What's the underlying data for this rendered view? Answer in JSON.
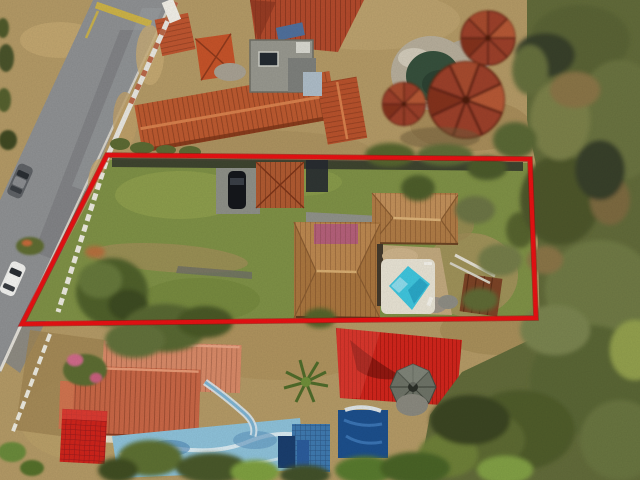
{
  "image": {
    "type": "aerial-drone-photograph",
    "description": "Aerial drone photo of a residential lot outlined with a red property boundary. Inside the boundary: green lawn, white balustrade fence along the road, carport with a dark car, main house with tan terracotta hip roofs and a pink roof patch, white pool deck with turquoise swimming pool, wooden rear deck and shrubs. Around it: a gray road with yellow speed bump and two parked cars (white and gray), neighboring terracotta-roofed buildings, a round stone-rimmed pond with three conical red-tile palapa roofs, a southern neighbor with salmon and bright-red roofs, blue painted pool deck, navy pool, red metal carport roof and a gazebo, all bordered by dense olive-green forest on the right."
  },
  "overlay": {
    "name": "red-property-boundary",
    "color": "#e81113",
    "points": "107,155 530,159 536,318 22,324",
    "stroke_px": 4
  },
  "palette": {
    "boundary_red": "#e81113",
    "road_asphalt": "#8f9193",
    "dry_grass": "#b49a66",
    "lawn_green": "#7f9146",
    "forest_olive": "#626b3a",
    "terracotta_roof": "#bd5a30",
    "house_tan_roof": "#b07c46",
    "pink_roof_patch": "#b5607a",
    "salmon_roof": "#d98a68",
    "bright_red_roof": "#cf241b",
    "pool_turquoise": "#3fc6de",
    "pool_deck_white": "#e8e3d4",
    "pond_water": "#36503c",
    "blue_pool_deck": "#8ec2da",
    "navy_pool": "#1c4f8c",
    "fence_white": "#eceadf",
    "speed_bump_yellow": "#d8b93c"
  },
  "objects": [
    {
      "name": "red-property-boundary",
      "label": "Red outlined lot"
    },
    {
      "name": "road",
      "label": "Asphalt road with speed bump"
    },
    {
      "name": "white-car",
      "label": "White parked car"
    },
    {
      "name": "gray-car",
      "label": "Gray parked car"
    },
    {
      "name": "white-fence",
      "label": "White wall and balustrade fence"
    },
    {
      "name": "north-neighbor-buildings",
      "label": "Terracotta roofed buildings"
    },
    {
      "name": "round-pond",
      "label": "Stone-rimmed round pond"
    },
    {
      "name": "palapa-roofs",
      "label": "Three conical tiled palapa roofs"
    },
    {
      "name": "carport",
      "label": "Carport with dark car"
    },
    {
      "name": "main-house",
      "label": "Main house tan hip roofs"
    },
    {
      "name": "swimming-pool",
      "label": "Turquoise pool on white deck"
    },
    {
      "name": "rear-deck",
      "label": "Wooden rear deck"
    },
    {
      "name": "south-neighbor-house",
      "label": "Salmon roofed neighbor house"
    },
    {
      "name": "bright-red-tile-roof",
      "label": "Bright red tiled roof"
    },
    {
      "name": "blue-pool-deck",
      "label": "Blue painted pool deck"
    },
    {
      "name": "navy-pool",
      "label": "Covered navy pool"
    },
    {
      "name": "red-metal-roof",
      "label": "Red corrugated metal roof"
    },
    {
      "name": "gazebo",
      "label": "Gazebo roof"
    },
    {
      "name": "forest",
      "label": "Dense trees"
    }
  ]
}
